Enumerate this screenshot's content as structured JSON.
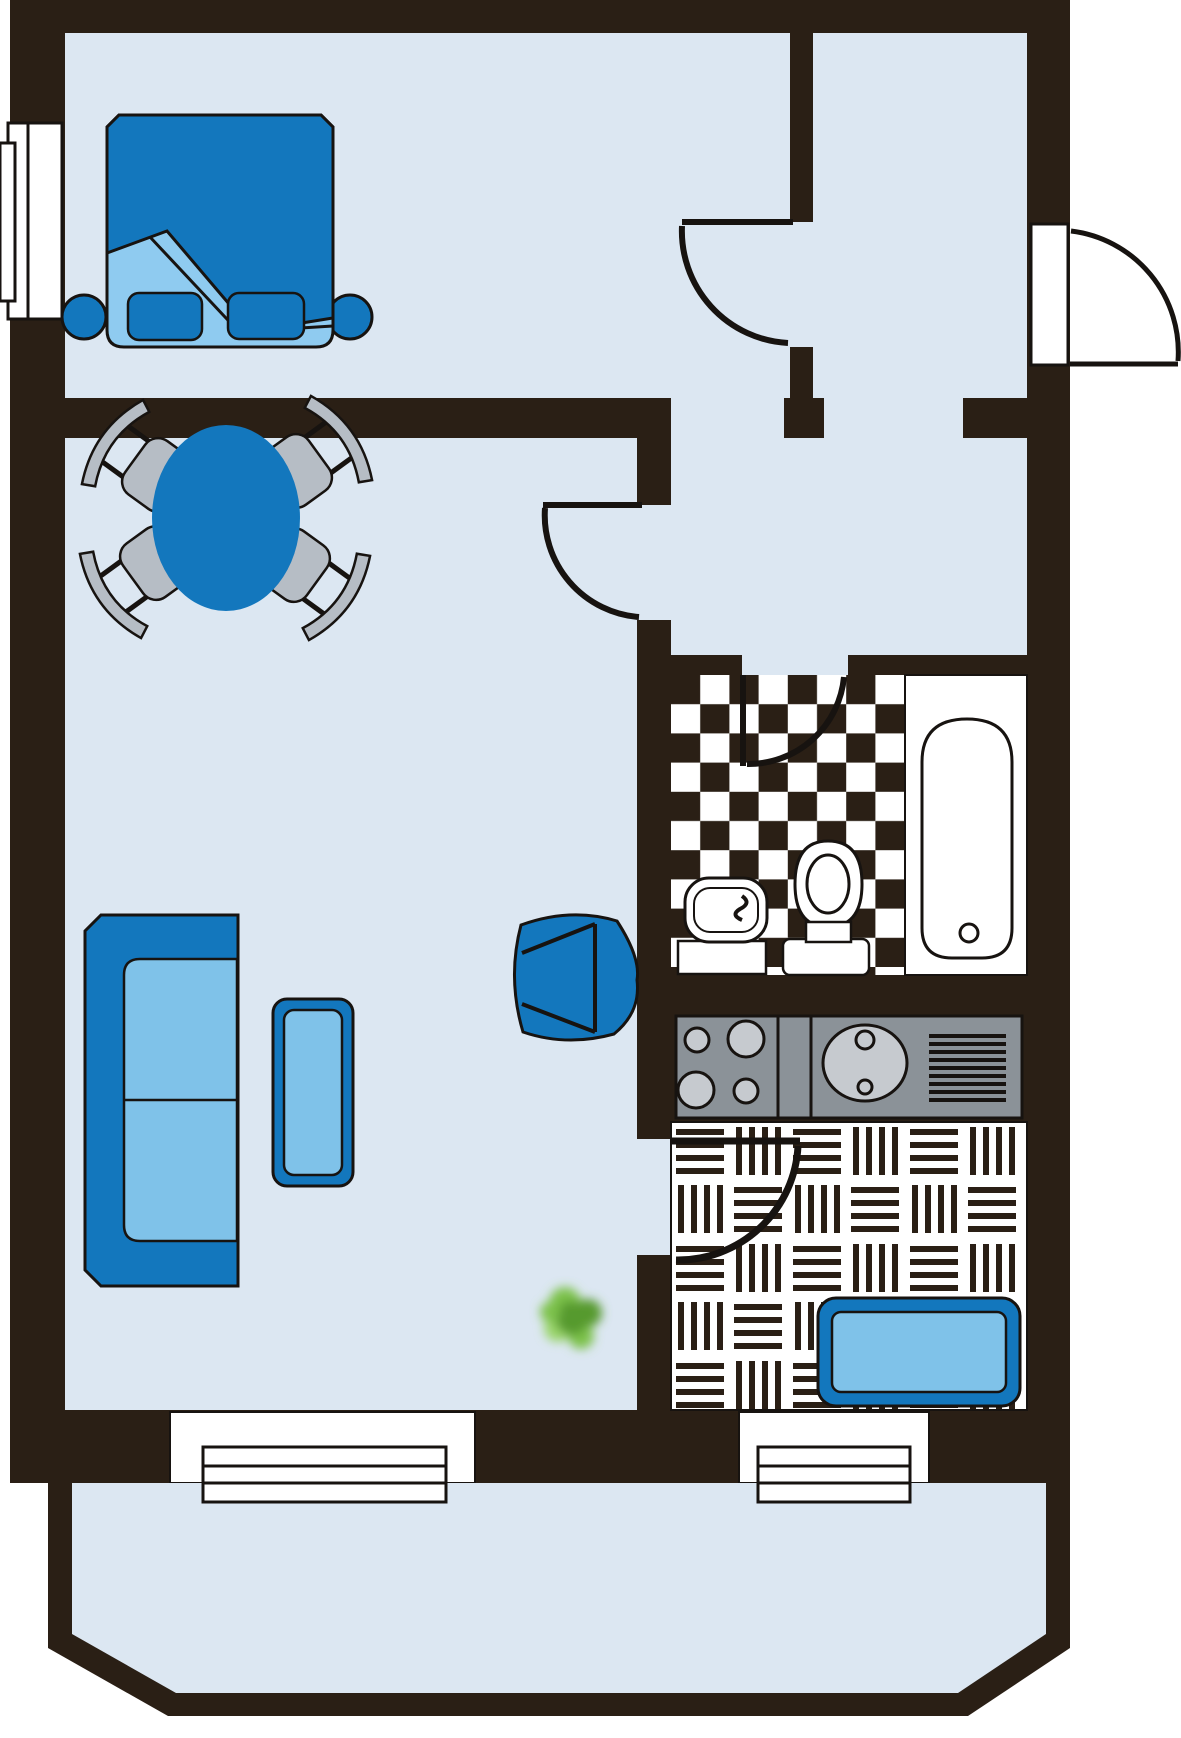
{
  "document": {
    "kind": "apartment-floor-plan",
    "text_labels": []
  },
  "colors": {
    "bg": "#ffffff",
    "wall": "#2a1f15",
    "outline": "#171310",
    "floor": "#dce7f2",
    "furniture_dark": "#1377bd",
    "furniture_light": "#7fc2e9",
    "bed_sheet": "#8fcbf0",
    "chair_gray": "#b6bdc5",
    "counter_gray": "#8b9298",
    "appliance_gray": "#c6cacf",
    "tile_white": "#ffffff",
    "plant_dark": "#569a2e",
    "plant_mid": "#7dc24c",
    "plant_light": "#9ad56b"
  },
  "rooms": [
    {
      "name": "bedroom",
      "floor": "plain"
    },
    {
      "name": "entry-hall",
      "floor": "plain"
    },
    {
      "name": "corridor",
      "floor": "plain"
    },
    {
      "name": "living-room",
      "floor": "plain"
    },
    {
      "name": "bathroom",
      "floor": "checkerboard"
    },
    {
      "name": "kitchen",
      "floor": "parquet"
    },
    {
      "name": "balcony",
      "floor": "plain"
    }
  ],
  "furniture": {
    "bedroom": [
      "double-bed",
      "pillow",
      "pillow",
      "nightstand",
      "nightstand"
    ],
    "living_room": [
      "dining-table",
      "dining-chair",
      "dining-chair",
      "dining-chair",
      "dining-chair",
      "sofa",
      "coffee-table",
      "armchair",
      "plant"
    ],
    "bathroom": [
      "washbasin",
      "toilet",
      "bathtub"
    ],
    "kitchen": [
      "stove",
      "kitchen-sink",
      "drainboard",
      "kitchen-table"
    ]
  },
  "counts": {
    "stove_burners": 4,
    "dining_chairs": 4,
    "doors": 5,
    "windows": 3
  },
  "doors": [
    "entry-door",
    "bedroom-door",
    "living-room-door",
    "bathroom-door",
    "kitchen-door"
  ],
  "windows": [
    "bedroom-left-window",
    "living-room-bottom-window",
    "kitchen-bottom-window"
  ]
}
